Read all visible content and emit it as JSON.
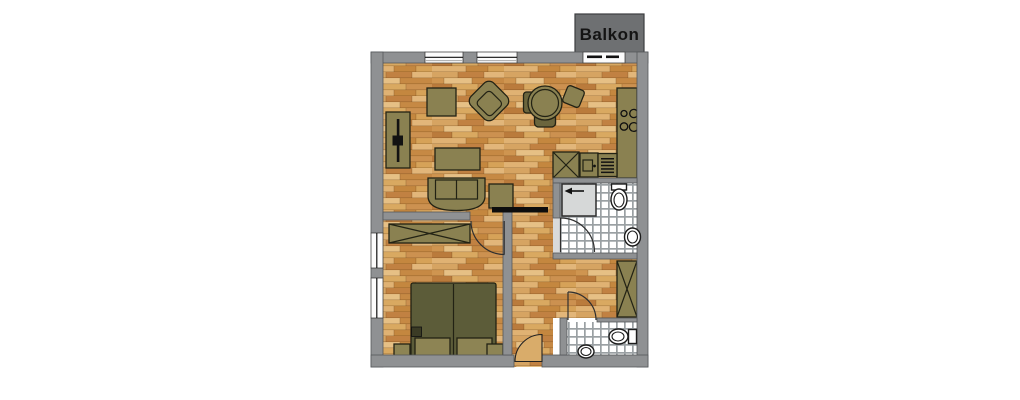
{
  "balcony": {
    "label": "Balkon"
  },
  "colors": {
    "background": "#ffffff",
    "wall": "#8f9193",
    "balcony_box": "#6e7072",
    "balcony_text": "#141414",
    "window_white": "#fbfbfb",
    "furniture": "#8a8151",
    "furniture_dark": "#6b653d",
    "bed": "#5c5c39",
    "bedding": "#8d8454",
    "bed_item": "#3b3b25",
    "ink": "#121212",
    "door_slider": "#0d0d0d",
    "door_leaf": "#d9ac6a",
    "shower": "#d6d8d8",
    "threshold": "#d9dadb",
    "basin": "#d9d9cd",
    "fixture_white": "#ffffff",
    "tile_white": "#ffffff",
    "tile_grout": "#9aa0a3",
    "plank_seam": "rgba(92,54,13,0.35)",
    "planks": [
      "#d6a462",
      "#c18142",
      "#e2b67a",
      "#cf9550",
      "#e6c085",
      "#c68944",
      "#ba7b3c",
      "#d9a961",
      "#cc9150",
      "#e0b273",
      "#c4873f",
      "#d6a258"
    ]
  },
  "fixtures_depicted": [
    "balcony-door",
    "windows",
    "tv-sideboard",
    "armchair",
    "side-table",
    "dining-table-with-chairs",
    "coffee-table",
    "sofa",
    "kitchen-counter",
    "stove-burners",
    "kitchen-sink",
    "dishwasher",
    "fridge-cabinet",
    "shower",
    "toilet",
    "wash-basin",
    "hall-closet",
    "wardrobe",
    "double-bed",
    "nightstands",
    "entrance-door",
    "sliding-door"
  ]
}
